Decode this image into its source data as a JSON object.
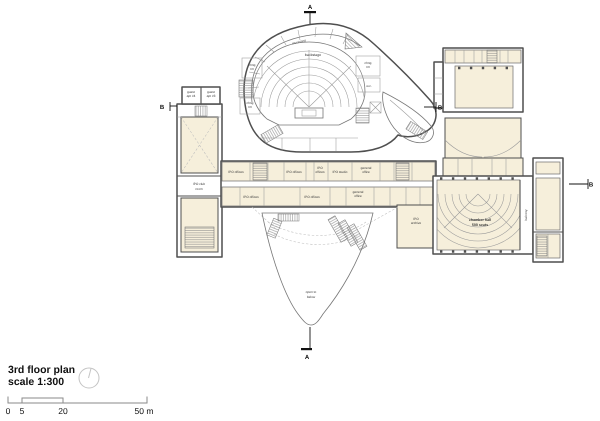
{
  "legend": {
    "title": "3rd floor plan",
    "scale_label": "scale 1:300"
  },
  "scale_bar": {
    "tick_labels": [
      "0",
      "5",
      "20",
      "50 m"
    ]
  },
  "section_markers": {
    "a": "A",
    "b": "B"
  },
  "labels": {
    "backstage": "backstage",
    "musicians": "musicians",
    "chng_rm": [
      "chng",
      "rm"
    ],
    "wc": "w.c.",
    "guest_apt_4": [
      "guest",
      "apt #4"
    ],
    "guest_apt_3": [
      "guest",
      "apt #3"
    ],
    "ipo_club_room": [
      "IPO club",
      "room"
    ],
    "ipo_offices": "IPO offices",
    "ipo_offices_2": [
      "IPO",
      "offices"
    ],
    "ipo_studio": "IPO studio",
    "general_office": [
      "general",
      "office"
    ],
    "ipo_archive": [
      "IPO",
      "archive"
    ],
    "chamber_hall": [
      "chamber hall",
      "500 seats"
    ],
    "balcony": "balcony",
    "open_to_below": [
      "open to",
      "below"
    ]
  },
  "icons": {
    "north": "north-arrow"
  },
  "colors": {
    "room_fill": "#f6efdb",
    "wall": "#4f4f4f",
    "thin_line": "#9a9a9a",
    "text": "#2b2b2b",
    "background": "#ffffff"
  }
}
